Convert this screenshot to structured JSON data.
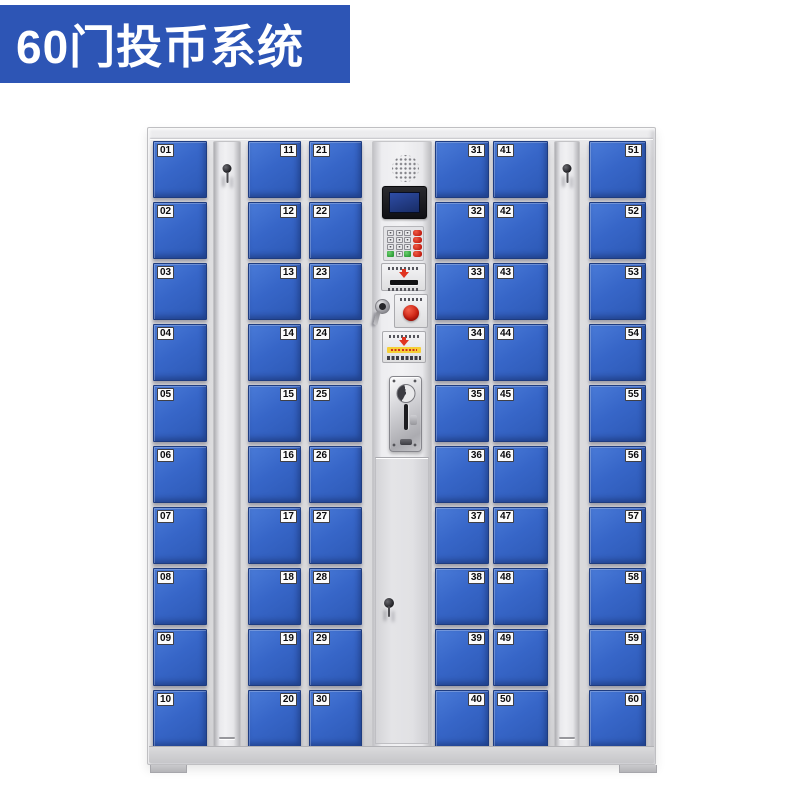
{
  "banner": {
    "text": "60门投币系统"
  },
  "cabinet": {
    "columns": [
      {
        "type": "doors",
        "side": "left",
        "doors": [
          "01",
          "02",
          "03",
          "04",
          "05",
          "06",
          "07",
          "08",
          "09",
          "10"
        ]
      },
      {
        "type": "lock"
      },
      {
        "type": "doors",
        "side": "right",
        "doors": [
          "11",
          "12",
          "13",
          "14",
          "15",
          "16",
          "17",
          "18",
          "19",
          "20"
        ]
      },
      {
        "type": "doors",
        "side": "left",
        "doors": [
          "21",
          "22",
          "23",
          "24",
          "25",
          "26",
          "27",
          "28",
          "29",
          "30"
        ]
      },
      {
        "type": "panel"
      },
      {
        "type": "doors",
        "side": "right",
        "doors": [
          "31",
          "32",
          "33",
          "34",
          "35",
          "36",
          "37",
          "38",
          "39",
          "40"
        ]
      },
      {
        "type": "doors",
        "side": "left",
        "doors": [
          "41",
          "42",
          "43",
          "44",
          "45",
          "46",
          "47",
          "48",
          "49",
          "50"
        ]
      },
      {
        "type": "lock"
      },
      {
        "type": "doors",
        "side": "right",
        "doors": [
          "51",
          "52",
          "53",
          "54",
          "55",
          "56",
          "57",
          "58",
          "59",
          "60"
        ]
      }
    ],
    "panel": {
      "components": [
        "speaker-grille",
        "lcd-display",
        "numeric-keypad",
        "card-reader-slot",
        "key-lock",
        "red-button",
        "instruction-plate",
        "coin-acceptor",
        "service-door-keyhole"
      ]
    },
    "door_count": "60"
  },
  "colors": {
    "banner_bg": "#2d55b5",
    "door_blue": "#3766c8",
    "cabinet_gray": "#d9d9db",
    "accent_red": "#d02615",
    "accent_green": "#3aa843",
    "screen_navy": "#20377f"
  }
}
